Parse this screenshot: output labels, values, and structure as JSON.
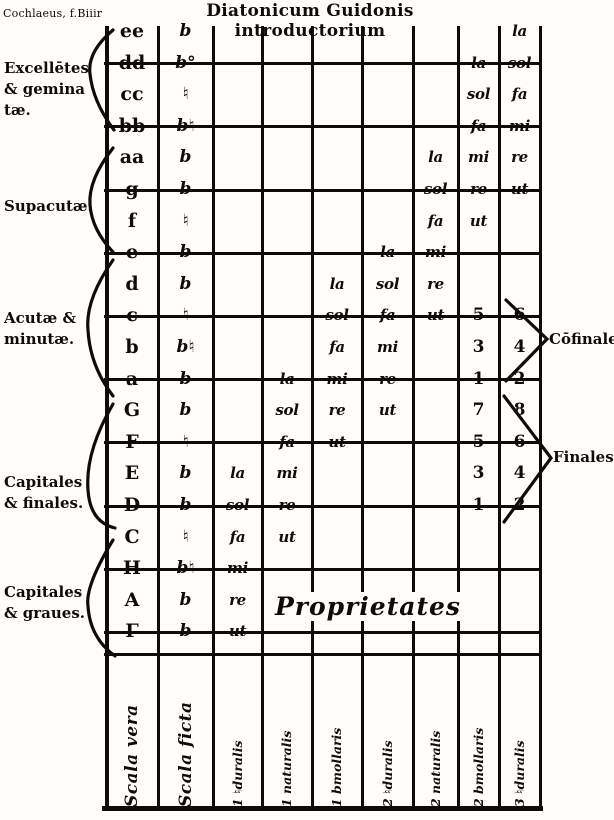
{
  "page": {
    "header_left": "Cochlaeus, f.Biiir",
    "title": "Diatonicum Guidonis introductorium",
    "ink_color": "#0d0c0a",
    "paper_color": "#fffefb"
  },
  "left_labels": [
    {
      "lines": [
        "Excellētes",
        "& gemina",
        "tæ."
      ]
    },
    {
      "lines": [
        "Supacutæ."
      ]
    },
    {
      "lines": [
        "Acutæ &",
        "minutæ."
      ]
    },
    {
      "lines": [
        "Capitales",
        "& finales."
      ]
    },
    {
      "lines": [
        "Capitales",
        "& graues."
      ]
    }
  ],
  "right_labels": [
    {
      "text": "Cōfinales."
    },
    {
      "text": "Finales"
    }
  ],
  "proprietates_label": "Proprietates",
  "gamut": {
    "columns": [
      {
        "label": "Scala vera"
      },
      {
        "label": "Scala ficta"
      },
      {
        "label": "1 ♮duralis"
      },
      {
        "label": "1 naturalis"
      },
      {
        "label": "1 bmollaris"
      },
      {
        "label": "2 ♮duralis"
      },
      {
        "label": "2 naturalis"
      },
      {
        "label": "2 bmollaris"
      },
      {
        "label": "3 ♮duralis"
      }
    ],
    "rows": [
      {
        "letter": "ee",
        "ficta": "b",
        "cells": [
          {
            "col": 9,
            "text": "la"
          }
        ]
      },
      {
        "letter": "dd",
        "ficta": "b°",
        "cells": [
          {
            "col": 8,
            "text": "la"
          },
          {
            "col": 9,
            "text": "sol"
          }
        ]
      },
      {
        "letter": "cc",
        "ficta": "♮",
        "cells": [
          {
            "col": 8,
            "text": "sol"
          },
          {
            "col": 9,
            "text": "fa"
          }
        ]
      },
      {
        "letter": "bb",
        "ficta": "b♮",
        "cells": [
          {
            "col": 8,
            "text": "fa"
          },
          {
            "col": 9,
            "text": "mi"
          }
        ]
      },
      {
        "letter": "aa",
        "ficta": "b",
        "cells": [
          {
            "col": 7,
            "text": "la"
          },
          {
            "col": 8,
            "text": "mi"
          },
          {
            "col": 9,
            "text": "re"
          }
        ]
      },
      {
        "letter": "g",
        "ficta": "b",
        "cells": [
          {
            "col": 7,
            "text": "sol"
          },
          {
            "col": 8,
            "text": "re"
          },
          {
            "col": 9,
            "text": "ut"
          }
        ]
      },
      {
        "letter": "f",
        "ficta": "♮",
        "cells": [
          {
            "col": 7,
            "text": "fa"
          },
          {
            "col": 8,
            "text": "ut"
          }
        ]
      },
      {
        "letter": "e",
        "ficta": "b",
        "cells": [
          {
            "col": 6,
            "text": "la"
          },
          {
            "col": 7,
            "text": "mi"
          }
        ]
      },
      {
        "letter": "d",
        "ficta": "b",
        "cells": [
          {
            "col": 5,
            "text": "la"
          },
          {
            "col": 6,
            "text": "sol"
          },
          {
            "col": 7,
            "text": "re"
          }
        ]
      },
      {
        "letter": "c",
        "ficta": "♮",
        "cells": [
          {
            "col": 5,
            "text": "sol"
          },
          {
            "col": 6,
            "text": "fa"
          },
          {
            "col": 7,
            "text": "ut"
          },
          {
            "col": 8,
            "text": "5"
          },
          {
            "col": 9,
            "text": "6"
          }
        ]
      },
      {
        "letter": "b",
        "ficta": "b♮",
        "cells": [
          {
            "col": 5,
            "text": "fa"
          },
          {
            "col": 6,
            "text": "mi"
          },
          {
            "col": 8,
            "text": "3"
          },
          {
            "col": 9,
            "text": "4"
          }
        ]
      },
      {
        "letter": "a",
        "ficta": "b",
        "cells": [
          {
            "col": 4,
            "text": "la"
          },
          {
            "col": 5,
            "text": "mi"
          },
          {
            "col": 6,
            "text": "re"
          },
          {
            "col": 8,
            "text": "1"
          },
          {
            "col": 9,
            "text": "2"
          }
        ]
      },
      {
        "letter": "G",
        "ficta": "b",
        "cells": [
          {
            "col": 4,
            "text": "sol"
          },
          {
            "col": 5,
            "text": "re"
          },
          {
            "col": 6,
            "text": "ut"
          },
          {
            "col": 8,
            "text": "7"
          },
          {
            "col": 9,
            "text": "8"
          }
        ]
      },
      {
        "letter": "F",
        "ficta": "♮",
        "cells": [
          {
            "col": 4,
            "text": "fa"
          },
          {
            "col": 5,
            "text": "ut"
          },
          {
            "col": 8,
            "text": "5"
          },
          {
            "col": 9,
            "text": "6"
          }
        ]
      },
      {
        "letter": "E",
        "ficta": "b",
        "cells": [
          {
            "col": 3,
            "text": "la"
          },
          {
            "col": 4,
            "text": "mi"
          },
          {
            "col": 8,
            "text": "3"
          },
          {
            "col": 9,
            "text": "4"
          }
        ]
      },
      {
        "letter": "D",
        "ficta": "b",
        "cells": [
          {
            "col": 3,
            "text": "sol"
          },
          {
            "col": 4,
            "text": "re"
          },
          {
            "col": 8,
            "text": "1"
          },
          {
            "col": 9,
            "text": "2"
          }
        ]
      },
      {
        "letter": "C",
        "ficta": "♮",
        "cells": [
          {
            "col": 3,
            "text": "fa"
          },
          {
            "col": 4,
            "text": "ut"
          }
        ]
      },
      {
        "letter": "H",
        "ficta": "b♮",
        "cells": [
          {
            "col": 3,
            "text": "mi"
          }
        ]
      },
      {
        "letter": "A",
        "ficta": "b",
        "cells": [
          {
            "col": 3,
            "text": "re"
          }
        ]
      },
      {
        "letter": "Γ",
        "ficta": "b",
        "cells": [
          {
            "col": 3,
            "text": "ut"
          }
        ]
      }
    ]
  }
}
